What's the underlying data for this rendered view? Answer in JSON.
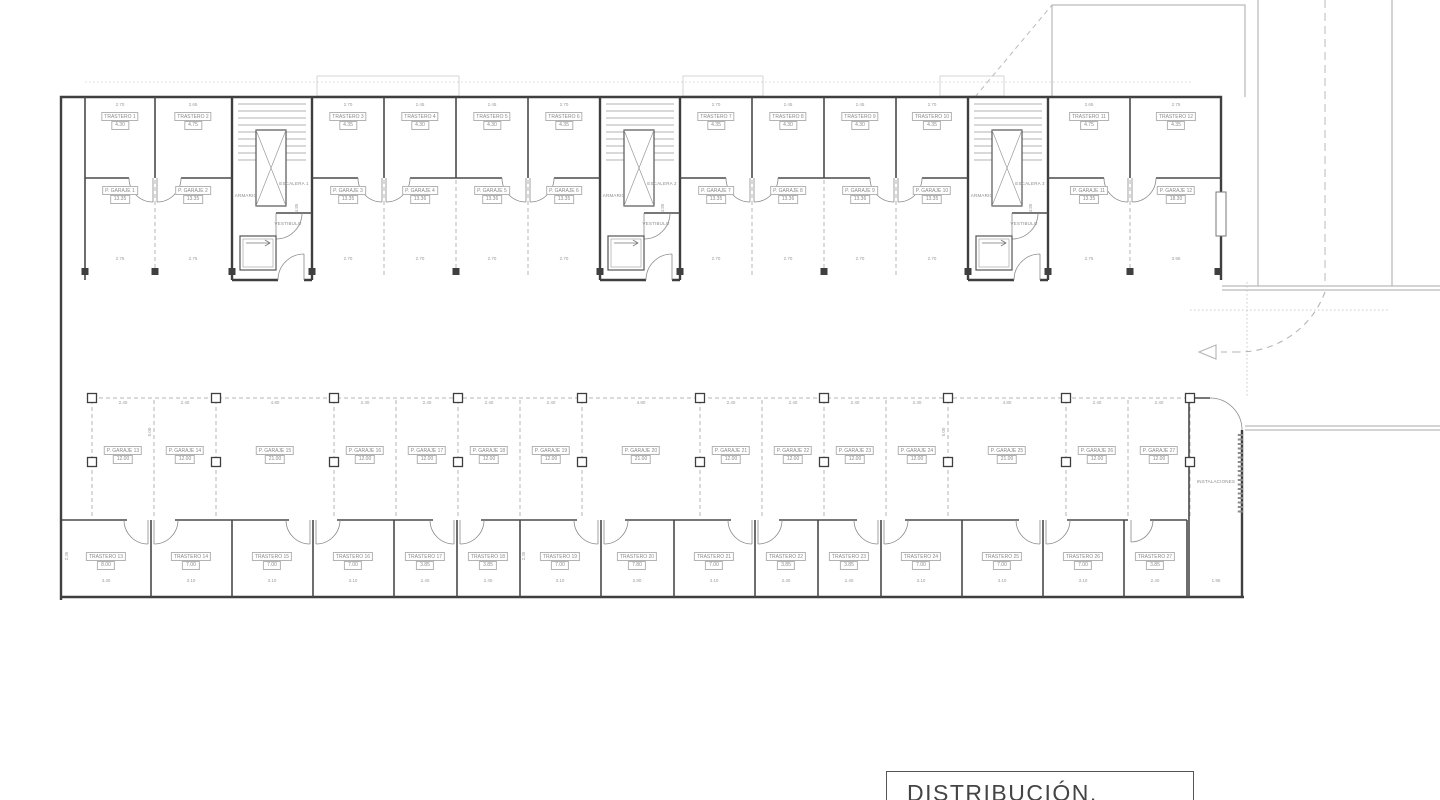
{
  "title_block": {
    "title": "DISTRIBUCIÓN."
  },
  "top_units": [
    {
      "trastero": "TRASTERO 1",
      "trastero_area": "4.30",
      "trastero_dim": "2.70",
      "garaje": "P. GARAJE 1",
      "garaje_area": "13.35",
      "garaje_dim": "2.75"
    },
    {
      "trastero": "TRASTERO 2",
      "trastero_area": "4.75",
      "trastero_dim": "2.65",
      "garaje": "P. GARAJE 2",
      "garaje_area": "13.35",
      "garaje_dim": "2.75"
    },
    {
      "trastero": "TRASTERO 3",
      "trastero_area": "4.35",
      "trastero_dim": "2.70",
      "garaje": "P. GARAJE 3",
      "garaje_area": "13.35",
      "garaje_dim": "2.70"
    },
    {
      "trastero": "TRASTERO 4",
      "trastero_area": "4.30",
      "trastero_dim": "2.45",
      "garaje": "P. GARAJE 4",
      "garaje_area": "13.36",
      "garaje_dim": "2.70"
    },
    {
      "trastero": "TRASTERO 5",
      "trastero_area": "4.30",
      "trastero_dim": "2.45",
      "garaje": "P. GARAJE 5",
      "garaje_area": "13.36",
      "garaje_dim": "2.70"
    },
    {
      "trastero": "TRASTERO 6",
      "trastero_area": "4.35",
      "trastero_dim": "2.70",
      "garaje": "P. GARAJE 6",
      "garaje_area": "13.35",
      "garaje_dim": "2.70"
    },
    {
      "trastero": "TRASTERO 7",
      "trastero_area": "4.35",
      "trastero_dim": "2.70",
      "garaje": "P. GARAJE 7",
      "garaje_area": "13.35",
      "garaje_dim": "2.70"
    },
    {
      "trastero": "TRASTERO 8",
      "trastero_area": "4.30",
      "trastero_dim": "2.45",
      "garaje": "P. GARAJE 8",
      "garaje_area": "13.36",
      "garaje_dim": "2.70"
    },
    {
      "trastero": "TRASTERO 9",
      "trastero_area": "4.30",
      "trastero_dim": "2.45",
      "garaje": "P. GARAJE 9",
      "garaje_area": "13.36",
      "garaje_dim": "2.70"
    },
    {
      "trastero": "TRASTERO 10",
      "trastero_area": "4.35",
      "trastero_dim": "2.70",
      "garaje": "P. GARAJE 10",
      "garaje_area": "13.35",
      "garaje_dim": "2.70"
    },
    {
      "trastero": "TRASTERO 11",
      "trastero_area": "4.75",
      "trastero_dim": "2.65",
      "garaje": "P. GARAJE 11",
      "garaje_area": "13.35",
      "garaje_dim": "2.75"
    },
    {
      "trastero": "TRASTERO 12",
      "trastero_area": "4.35",
      "trastero_dim": "2.75",
      "garaje": "P. GARAJE 12",
      "garaje_area": "18.30",
      "garaje_dim": "3.95"
    }
  ],
  "stair_cores": [
    {
      "escalera": "ESCALERA 1",
      "armario": "ARMARIO",
      "vestibulo": "VESTIBULO"
    },
    {
      "escalera": "ESCALERA 2",
      "armario": "ARMARIO",
      "vestibulo": "VESTIBULO"
    },
    {
      "escalera": "ESCALERA 3",
      "armario": "ARMARIO",
      "vestibulo": "VESTIBULO"
    }
  ],
  "parking_spaces": [
    {
      "name": "P. GARAJE 13",
      "area": "12.00",
      "dim": "2.40"
    },
    {
      "name": "P. GARAJE 14",
      "area": "12.00",
      "dim": "2.40"
    },
    {
      "name": "P. GARAJE 15",
      "area": "21.00",
      "dim": "4.80"
    },
    {
      "name": "P. GARAJE 16",
      "area": "12.00",
      "dim": "2.40"
    },
    {
      "name": "P. GARAJE 17",
      "area": "12.00",
      "dim": "2.40"
    },
    {
      "name": "P. GARAJE 18",
      "area": "12.00",
      "dim": "2.40"
    },
    {
      "name": "P. GARAJE 19",
      "area": "12.00",
      "dim": "2.40"
    },
    {
      "name": "P. GARAJE 20",
      "area": "21.00",
      "dim": "4.80"
    },
    {
      "name": "P. GARAJE 21",
      "area": "12.00",
      "dim": "2.40"
    },
    {
      "name": "P. GARAJE 22",
      "area": "12.00",
      "dim": "2.40"
    },
    {
      "name": "P. GARAJE 23",
      "area": "12.00",
      "dim": "2.40"
    },
    {
      "name": "P. GARAJE 24",
      "area": "12.00",
      "dim": "2.40"
    },
    {
      "name": "P. GARAJE 25",
      "area": "21.00",
      "dim": "4.80"
    },
    {
      "name": "P. GARAJE 26",
      "area": "12.00",
      "dim": "2.40"
    },
    {
      "name": "P. GARAJE 27",
      "area": "12.00",
      "dim": "2.40"
    }
  ],
  "storage_rooms": [
    {
      "name": "TRASTERO 13",
      "area": "8.00",
      "dim": "3.40"
    },
    {
      "name": "TRASTERO 14",
      "area": "7.00",
      "dim": "3.10"
    },
    {
      "name": "TRASTERO 15",
      "area": "7.00",
      "dim": "3.10"
    },
    {
      "name": "TRASTERO 16",
      "area": "7.00",
      "dim": "3.10"
    },
    {
      "name": "TRASTERO 17",
      "area": "3.85",
      "dim": "2.40"
    },
    {
      "name": "TRASTERO 18",
      "area": "3.85",
      "dim": "2.40"
    },
    {
      "name": "TRASTERO 19",
      "area": "7.00",
      "dim": "3.10"
    },
    {
      "name": "TRASTERO 20",
      "area": "7.80",
      "dim": "2.80"
    },
    {
      "name": "TRASTERO 21",
      "area": "7.00",
      "dim": "3.10"
    },
    {
      "name": "TRASTERO 22",
      "area": "3.85",
      "dim": "2.40"
    },
    {
      "name": "TRASTERO 23",
      "area": "3.85",
      "dim": "2.40"
    },
    {
      "name": "TRASTERO 24",
      "area": "7.00",
      "dim": "3.10"
    },
    {
      "name": "TRASTERO 25",
      "area": "7.00",
      "dim": "3.10"
    },
    {
      "name": "TRASTERO 26",
      "area": "7.00",
      "dim": "3.10"
    },
    {
      "name": "TRASTERO 27",
      "area": "3.85",
      "dim": "2.40"
    }
  ],
  "instalaciones": {
    "name": "INSTALACIONES",
    "dim": "1.95"
  },
  "vertical_dims": {
    "garage_depth": "4.85",
    "parking_depth": "5.00",
    "storage_depth": "2.35"
  }
}
